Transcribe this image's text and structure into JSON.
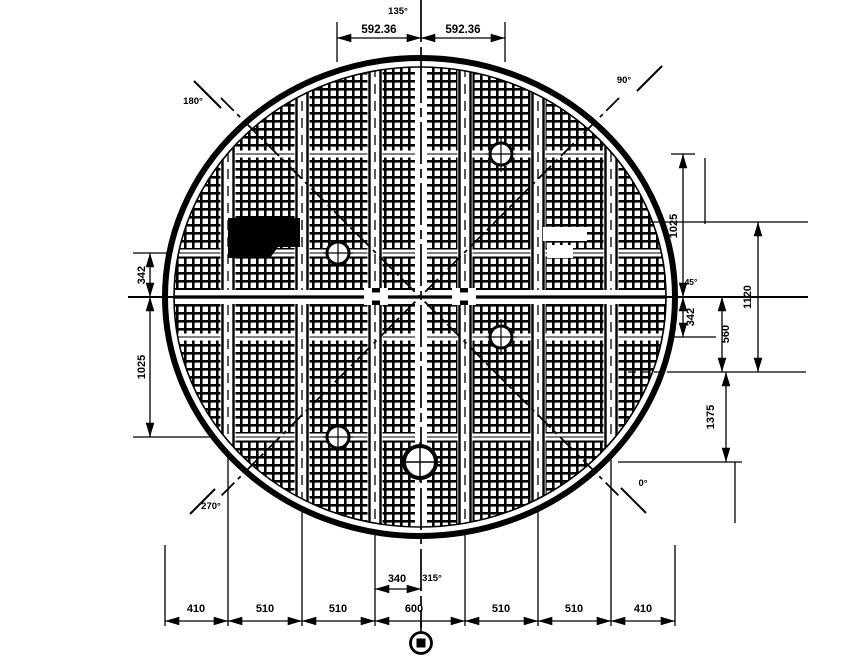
{
  "colors": {
    "ink": "#000000",
    "paper": "#ffffff"
  },
  "angle_labels": {
    "top": "135°",
    "upper_left": "180°",
    "upper_right": "90°",
    "right": "45°",
    "lower_right": "0°",
    "bottom": "315°",
    "lower_left": "270°"
  },
  "top_dims": {
    "left": "592.36",
    "right": "592.36"
  },
  "bottom_dims": {
    "chain": [
      "410",
      "510",
      "510",
      "600",
      "510",
      "510",
      "410"
    ],
    "offset": "340"
  },
  "left_dims": {
    "upper": "342",
    "lower": "1025"
  },
  "right_dims": {
    "radius": "1025",
    "offset": "342",
    "mid": "560",
    "span": "1120",
    "lower": "1375"
  }
}
